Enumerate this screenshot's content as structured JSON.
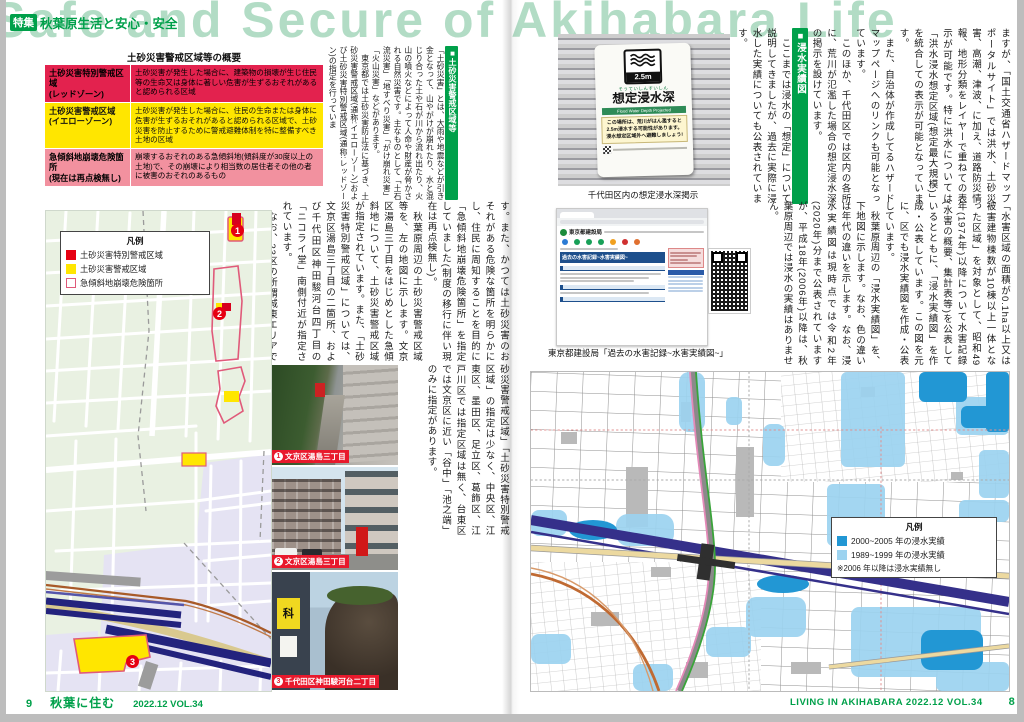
{
  "header": {
    "title_en": "Safe and Secure of Akihabara Life",
    "feature_tag": "特集",
    "feature_title": "秋葉原生活と安心・安全"
  },
  "left_page": {
    "table": {
      "title": "土砂災害警戒区域等の概要",
      "rows": [
        {
          "label": "土砂災害特別警戒区域\n(レッドゾーン)",
          "desc": "土砂災害が発生した場合に、建築物の損壊が生じ住民等の生命又は身体に著しい危害が生ずるおそれがあると認められる区域"
        },
        {
          "label": "土砂災害警戒区域\n(イエローゾーン)",
          "desc": "土砂災害が発生した場合に、住民の生命または身体に危害が生ずるおそれがあると認められる区域で、土砂災害を防止するために警戒避難体制を特に整備すべき土地の区域"
        },
        {
          "label": "急傾斜地崩壊危険箇所\n(現在は再点検無し)",
          "desc": "崩壊するおそれのある急傾斜地(傾斜度が30度以上の土地)で、その崩壊により相当数の居住者その他の者に被害のおそれのあるもの"
        }
      ]
    },
    "section": {
      "heading": "■土砂災害警戒区域等",
      "p1": "「土砂災害」とは、大雨や地震などが引き金となって、山やがけが崩れたり、水と混じり合った土や石が川から流れ出たり、火山の噴火などによって人命や財産が脅かされる自然災害です。主なものとして「土石流災害」「地すべり災害」「がけ崩れ災害」「火山災害」などがあります。",
      "p2": "　東京都では土砂災害防止法に基づき、土砂災害警戒区域(通称:イエローゾーン)および土砂災害特別警戒区域(通称:レッドゾーン)の指定を行っていま"
    },
    "text_b": {
      "p1": "す。また、かつては土砂災害のおそれがある危険な箇所を明らかにし、住民に周知することを目的に「急傾斜地崩壊危険箇所」を指定していました(制度の移行に伴い現在は再点検無し)。",
      "p2": "　秋葉原周辺の土砂災害警戒区域等を、左の地図に示します。文京区湯島三丁目をはじめとした急傾斜地について、土砂災害警戒区域が指定されています。また、「土砂災害特別警戒区域」については、文京区湯島三丁目の二箇所、および千代田区神田駿河台四丁目の「ニコライ堂」南側付近が指定されています。",
      "p3": "　なお、23区の所謂城東エリアでは「土"
    },
    "text_c": {
      "p1": "砂災害警戒区域」「土砂災害特別警戒区域」の指定は少なく、中央区、江東区、墨田区、足立区、葛飾区、江戸川区では指定区域は無く、台東区では文京区に近い「谷中」「池之端」のみに指定があります。"
    },
    "map": {
      "legend": {
        "title": "凡例",
        "items": [
          {
            "label": "土砂災害特別警戒区域",
            "color": "#e60012"
          },
          {
            "label": "土砂災害警戒区域",
            "color": "#ffe600"
          },
          {
            "label": "急傾斜地崩壊危険箇所",
            "color": "#ffffff"
          }
        ]
      },
      "markers": [
        "1",
        "2",
        "3"
      ]
    },
    "photos": [
      {
        "num": "1",
        "caption": "文京区湯島三丁目"
      },
      {
        "num": "2",
        "caption": "文京区湯島三丁目"
      },
      {
        "num": "3",
        "caption": "千代田区神田駿河台二丁目",
        "sign_text": "科"
      }
    ],
    "footer": {
      "page": "9",
      "logo": "秋葉に住む",
      "issue": "2022.12 VOL.34"
    }
  },
  "right_page": {
    "sign": {
      "depth": "2.5m",
      "kana": "そうていしんすいしん",
      "title": "想定浸水深",
      "subtitle": "Flood Water Depth Projected",
      "warn1": "この場所は、荒川がはん濫すると",
      "warn2": "2.5m浸水する可能性があります。",
      "warn3": "浸水想定区域外へ避難しましょう!"
    },
    "sign_caption": "千代田区内の想定浸水深掲示",
    "text_r1": {
      "p1": "ますが、「国土交通省ハザードマップポータルサイト」では洪水、土砂災害、高潮、津波、に加え、道路防災情報、地形分類をレイヤーで重ねての表示が可能です。特に洪水については「洪水浸水想定区域(想定最大規模)」を統合しての表示が可能となっています。",
      "p2": "　また、自治体が作成してるハザードマップページへのリンクも可能となっています。",
      "p3": "　このほか、千代田区では区内の各所に、荒川が氾濫した場合の想定浸水深の掲示を設けています。",
      "heading": "■浸水実績図",
      "p4": "　ここまでは浸水の「想定」について説明してきましたが、過去に実際に浸水した実績についても公表されています。"
    },
    "text_r2": {
      "p1": "「水害区域の面積が0.1ha以上又は被害建物棟数が10棟以上一体となった区域」を対象として、昭和49年(1974年)以降について水害記録(水害の概要、集計表等)を公表しているとともに、「浸水実績図」を作成・公表しています。この図を元に、区でも浸水実績図を作成・公表しています。",
      "p2": "　秋葉原周辺の「浸水実績図」を、下地図に示します。なお、色の違いは年代の違いを示します。なお、浸水実績図は現時点では令和2年(2020年)分まで公表されていますが、平成18年(2006年)以降は、秋葉原周辺では浸水の実績はありません。"
    },
    "browser": {
      "site_name": "東京都建設局",
      "banner": "過去の水害記録~水害実績図~"
    },
    "browser_caption": "東京都建設局「過去の水害記録~水害実績図~」",
    "map": {
      "legend": {
        "title": "凡例",
        "items": [
          {
            "label": "2000~2005 年の浸水実績",
            "color": "#2297d4"
          },
          {
            "label": "1989~1999 年の浸水実績",
            "color": "#9cd3f0"
          }
        ],
        "note": "※2006 年以降は浸水実績無し"
      }
    },
    "footer": {
      "text": "LIVING IN AKIHABARA  2022.12 VOL.34",
      "page": "8"
    }
  }
}
